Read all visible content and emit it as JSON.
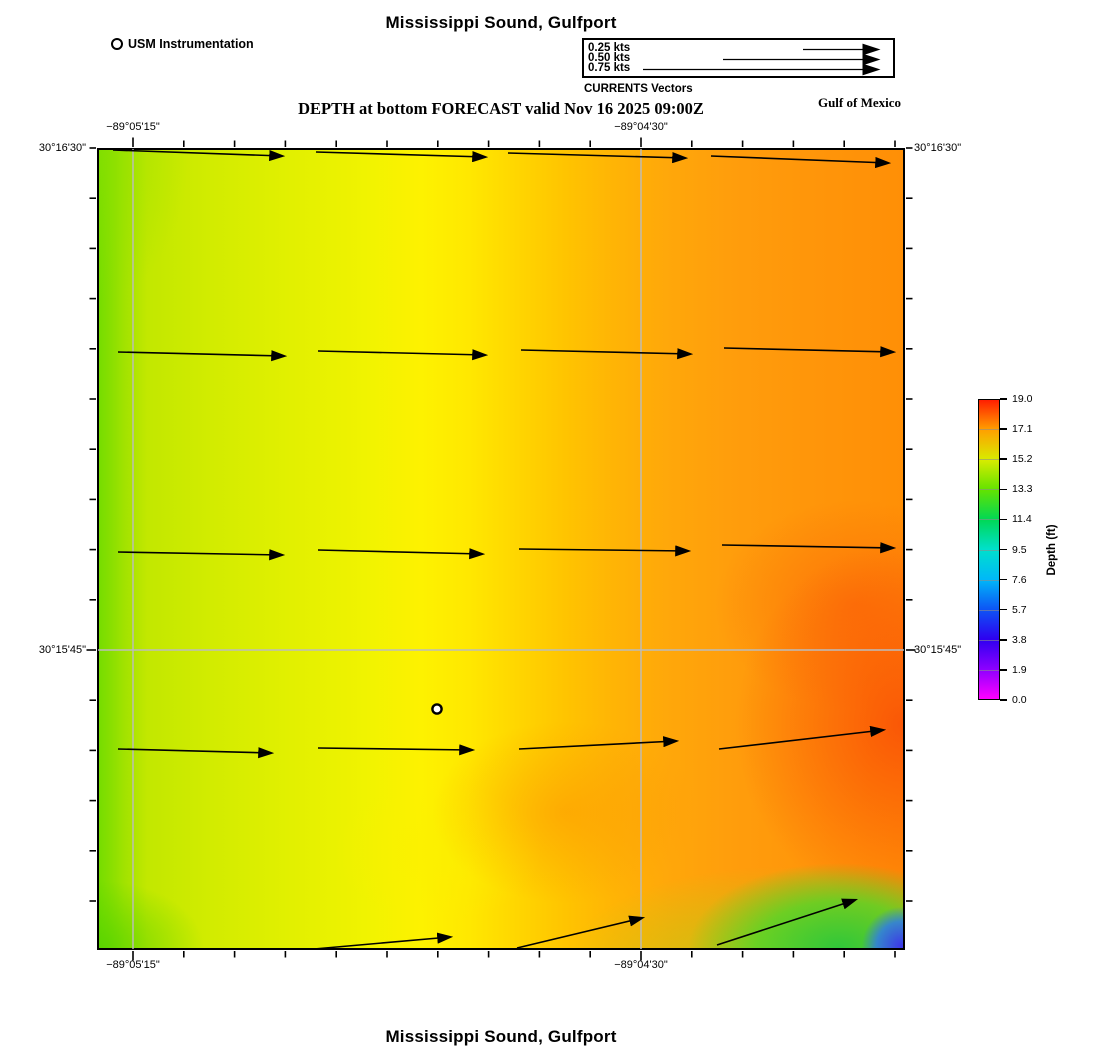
{
  "header": {
    "title": "Mississippi Sound, Gulfport",
    "station_legend_label": "USM Instrumentation",
    "vector_legend": {
      "caption": "CURRENTS Vectors",
      "arrow_end_x": 294,
      "items": [
        {
          "label": "0.25 kts",
          "speed_kts": 0.25,
          "arrow_start_x": 219
        },
        {
          "label": "0.50 kts",
          "speed_kts": 0.5,
          "arrow_start_x": 139
        },
        {
          "label": "0.75 kts",
          "speed_kts": 0.75,
          "arrow_start_x": 59
        }
      ]
    },
    "subtitle": "DEPTH at bottom FORECAST valid Nov 16 2025 09:00Z",
    "region_label": "Gulf of Mexico"
  },
  "footer": {
    "title": "Mississippi Sound, Gulfport"
  },
  "map": {
    "frame": {
      "left": 97,
      "top": 148,
      "right": 905,
      "bottom": 950
    },
    "gridlines": {
      "x": [
        133,
        641
      ],
      "y": [
        650
      ]
    },
    "lon_labels": [
      {
        "text": "−89°05'15\"",
        "x": 133
      },
      {
        "text": "−89°04'30\"",
        "x": 641
      }
    ],
    "lat_labels": [
      {
        "text": "30°16'30\"",
        "y": 148
      },
      {
        "text": "30°15'45\"",
        "y": 650
      }
    ],
    "station_marker": {
      "x": 437,
      "y": 709
    },
    "vectors": [
      {
        "x1": 113,
        "y1": 150,
        "x2": 282,
        "y2": 156
      },
      {
        "x1": 316,
        "y1": 152,
        "x2": 485,
        "y2": 157
      },
      {
        "x1": 508,
        "y1": 153,
        "x2": 685,
        "y2": 158
      },
      {
        "x1": 711,
        "y1": 156,
        "x2": 888,
        "y2": 163
      },
      {
        "x1": 118,
        "y1": 352,
        "x2": 284,
        "y2": 356
      },
      {
        "x1": 318,
        "y1": 351,
        "x2": 485,
        "y2": 355
      },
      {
        "x1": 521,
        "y1": 350,
        "x2": 690,
        "y2": 354
      },
      {
        "x1": 724,
        "y1": 348,
        "x2": 893,
        "y2": 352
      },
      {
        "x1": 118,
        "y1": 552,
        "x2": 282,
        "y2": 555
      },
      {
        "x1": 318,
        "y1": 550,
        "x2": 482,
        "y2": 554
      },
      {
        "x1": 519,
        "y1": 549,
        "x2": 688,
        "y2": 551
      },
      {
        "x1": 722,
        "y1": 545,
        "x2": 893,
        "y2": 548
      },
      {
        "x1": 118,
        "y1": 749,
        "x2": 271,
        "y2": 753
      },
      {
        "x1": 318,
        "y1": 748,
        "x2": 472,
        "y2": 750
      },
      {
        "x1": 519,
        "y1": 749,
        "x2": 676,
        "y2": 741
      },
      {
        "x1": 719,
        "y1": 749,
        "x2": 883,
        "y2": 730
      },
      {
        "x1": 314,
        "y1": 949,
        "x2": 450,
        "y2": 937
      },
      {
        "x1": 517,
        "y1": 948,
        "x2": 642,
        "y2": 918
      },
      {
        "x1": 717,
        "y1": 945,
        "x2": 855,
        "y2": 900
      }
    ]
  },
  "colorbar": {
    "title": "Depth (ft)",
    "tick_labels": [
      "19.0",
      "17.1",
      "15.2",
      "13.3",
      "11.4",
      "9.5",
      "7.6",
      "5.7",
      "3.8",
      "1.9",
      "0.0"
    ],
    "left": 978,
    "top": 399,
    "width": 22,
    "height": 301
  },
  "chart_data": {
    "type": "heatmap",
    "title": "Mississippi Sound, Gulfport",
    "subtitle": "DEPTH at bottom FORECAST valid Nov 16 2025 09:00Z",
    "variable": "Depth (ft)",
    "color_scale": {
      "min": 0.0,
      "max": 19.0,
      "ticks": [
        19.0,
        17.1,
        15.2,
        13.3,
        11.4,
        9.5,
        7.6,
        5.7,
        3.8,
        1.9,
        0.0
      ],
      "colors_low_to_high": [
        "#ff00ff",
        "#8c00ff",
        "#2e00f0",
        "#0d55f5",
        "#00b8f8",
        "#00e0cc",
        "#00d855",
        "#63e300",
        "#d8ec00",
        "#ffa000",
        "#ff1e00"
      ]
    },
    "x_axis": {
      "ticks": [
        "−89°05'15\"",
        "−89°04'30\""
      ]
    },
    "y_axis": {
      "ticks": [
        "30°16'30\"",
        "30°15'45\""
      ]
    },
    "field_description": "Bottom depth increases from ~13–14 ft (yellow-green) along the west edge to ~17–19 ft (orange-red) in the east; a shallow pocket (~0–11 ft, green to blue) sits in the southeast corner",
    "vectors": {
      "quantity": "currents",
      "legend_speeds_kts": [
        0.25,
        0.5,
        0.75
      ],
      "approx_speed_kts": 0.5,
      "direction": "eastward, bending northeastward near the south edge",
      "station_marker": "USM Instrumentation"
    }
  }
}
